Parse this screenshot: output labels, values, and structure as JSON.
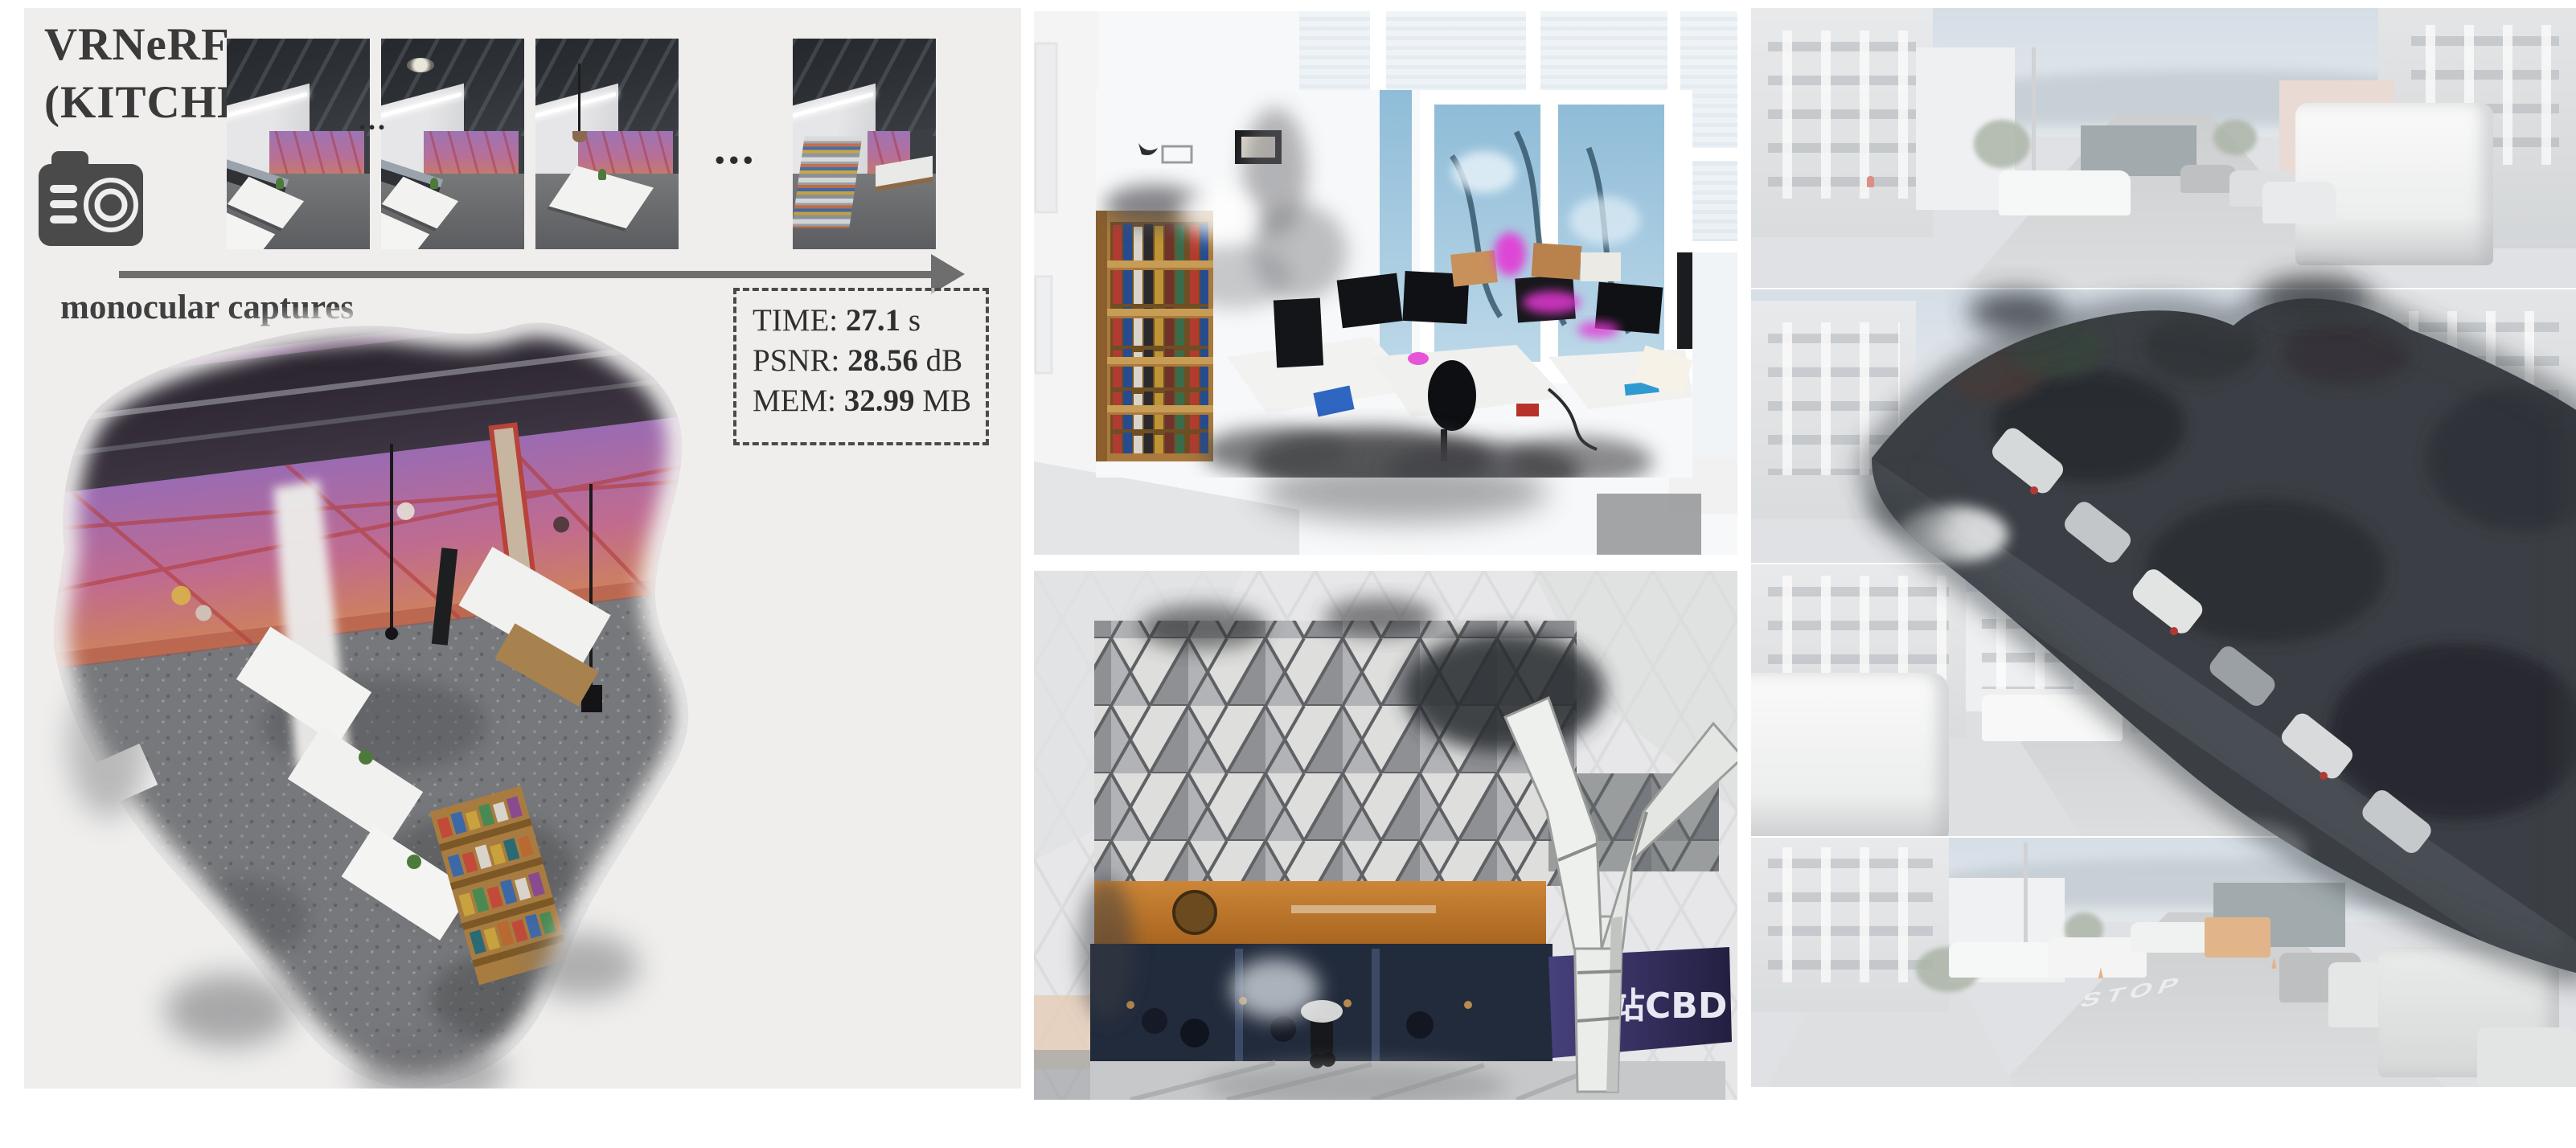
{
  "figure": {
    "kind": "paper-figure",
    "left_panel": {
      "title_line1": "VRNeRF",
      "title_line2": "(KITCHEN)",
      "camera_icon": "camera",
      "captures_label": "monocular captures",
      "ellipsis_small": "...",
      "ellipsis_large": "...",
      "thumbnail_count": 4,
      "metrics_box": {
        "rows": [
          {
            "label": "TIME: ",
            "value": "27.1",
            "unit": " s"
          },
          {
            "label": "PSNR: ",
            "value": "28.56",
            "unit": " dB"
          },
          {
            "label": "MEM: ",
            "value": "32.99",
            "unit": " MB"
          }
        ]
      }
    },
    "middle_panel": {
      "top_image": "office-room-reconstruction",
      "bottom_image": "station-building-reconstruction",
      "storefront_sign_text": "北站CBD"
    },
    "right_panel": {
      "image": "street-scene-reconstruction-collage",
      "road_marking_text": "STOP"
    },
    "colors": {
      "page_bg": "#ffffff",
      "panel_bg": "#efeeed",
      "ink": "#3a3a3a",
      "arrow_gray": "#6e6e6e",
      "metrics_border": "#4a4a4a",
      "mural_purple": "#9d74b4",
      "mural_salmon": "#c77f5e",
      "magenta_artifact": "#e438d4",
      "banner_orange": "#c07b33",
      "sign_purple": "#3c3768",
      "reconstruction_dark": "#34383d"
    }
  }
}
